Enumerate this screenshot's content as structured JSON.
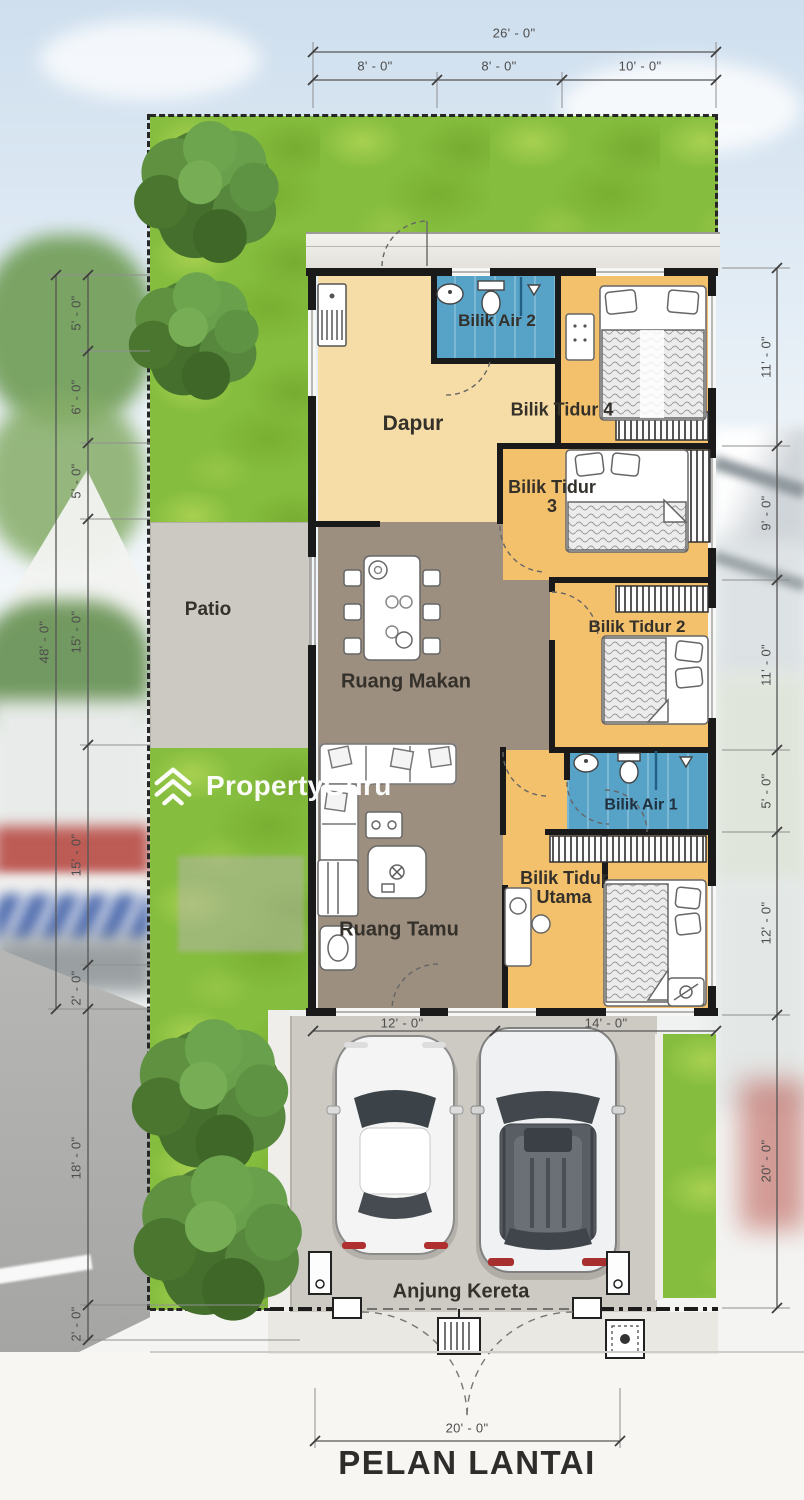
{
  "brand": {
    "watermark": "PropertyGuru"
  },
  "title": "PELAN LANTAI",
  "rooms": {
    "dapur": "Dapur",
    "bilik_air_2": "Bilik Air 2",
    "bilik_tidur_4": "Bilik Tidur 4",
    "bilik_tidur_3": [
      "Bilik Tidur",
      "3"
    ],
    "bilik_tidur_2": "Bilik Tidur 2",
    "ruang_makan": "Ruang Makan",
    "patio": "Patio",
    "bilik_air_1": "Bilik Air 1",
    "bilik_tidur_utama": [
      "Bilik Tidur",
      "Utama"
    ],
    "ruang_tamu": "Ruang Tamu",
    "anjung_kereta": "Anjung Kereta"
  },
  "dimensions": {
    "top": {
      "total": "26' - 0\"",
      "segments": [
        "8' - 0\"",
        "8' - 0\"",
        "10' - 0\""
      ]
    },
    "left": {
      "total": "48' - 0\"",
      "segments": [
        "5' - 0\"",
        "6' - 0\"",
        "5' - 0\"",
        "15' - 0\"",
        "15' - 0\"",
        "2' - 0\""
      ],
      "lower": [
        "18' - 0\"",
        "2' - 0\""
      ]
    },
    "right": {
      "segments": [
        "11' - 0\"",
        "9' - 0\"",
        "11' - 0\"",
        "5' - 0\"",
        "12' - 0\"",
        "20' - 0\""
      ]
    },
    "bottom": {
      "segments": [
        "12' - 0\"",
        "14' - 0\""
      ],
      "gate": "20' - 0\""
    }
  },
  "palette": {
    "bedroom_orange": "#f3c06c",
    "kitchen_cream": "#f6dca6",
    "bathroom_blue": "#57a3c8",
    "living_brown": "#9d8f80",
    "patio_gray": "#ccc9c2",
    "carport_gray": "#cdcac3",
    "grass_green": "#85bd3e",
    "wall_black": "#1a1a1a",
    "watermark_white": "#ffffff"
  }
}
